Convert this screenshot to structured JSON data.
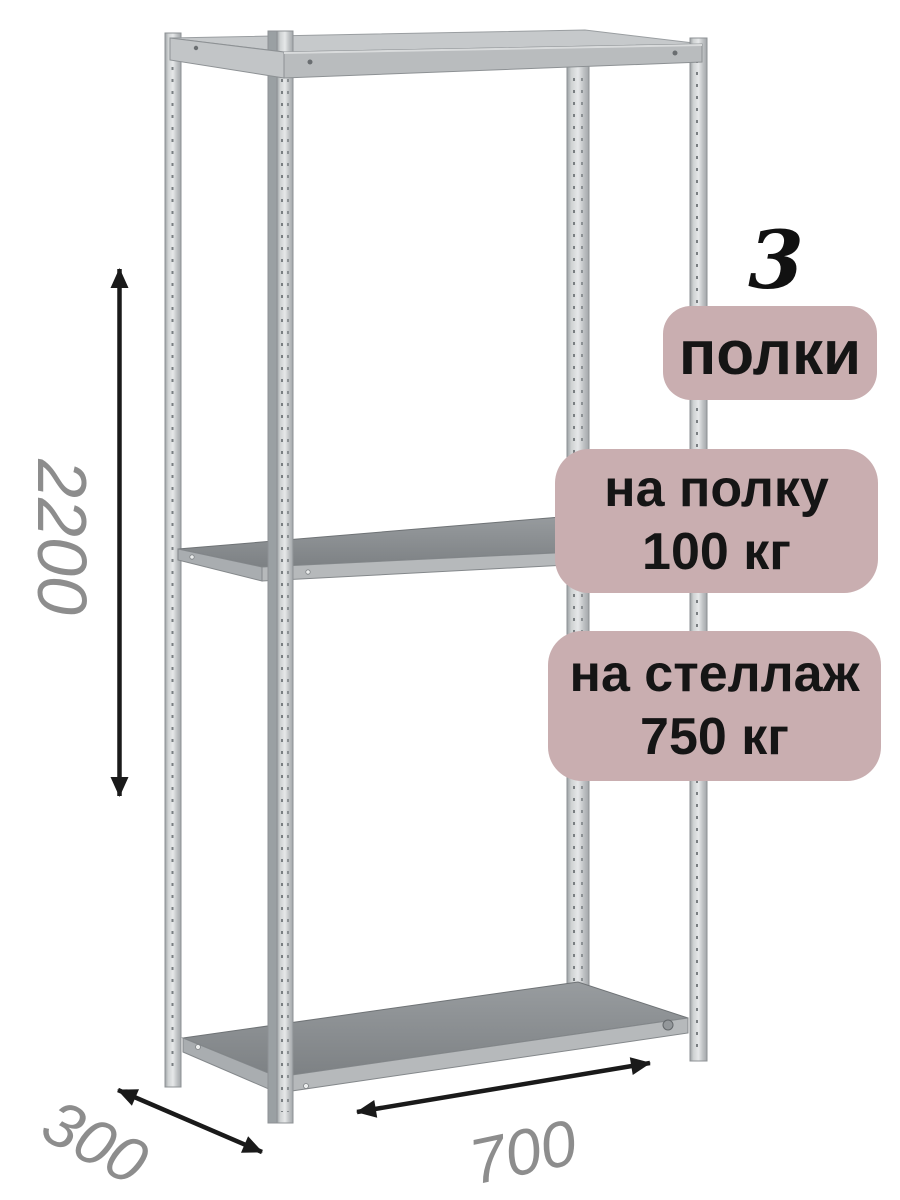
{
  "image": {
    "dimensions": {
      "height": "2200",
      "depth": "300",
      "width": "700"
    },
    "badges": {
      "shelf_count_value": "3",
      "shelf_count_label": "полки",
      "shelf_load_line1": "на полку",
      "shelf_load_line2": "100 кг",
      "rack_load_line1": "на стеллаж",
      "rack_load_line2": "750 кг"
    },
    "colors": {
      "badge_background": "#c9aeb0",
      "badge_text": "#151515",
      "dimension_text": "#8d8d8d",
      "count_number": "#111111",
      "arrow": "#1a1a1a",
      "metal_light": "#e6e8e9",
      "metal_dark": "#9ba0a3",
      "shelf_surface": "#85898c",
      "shelf_edge": "#b6b9bb"
    }
  }
}
